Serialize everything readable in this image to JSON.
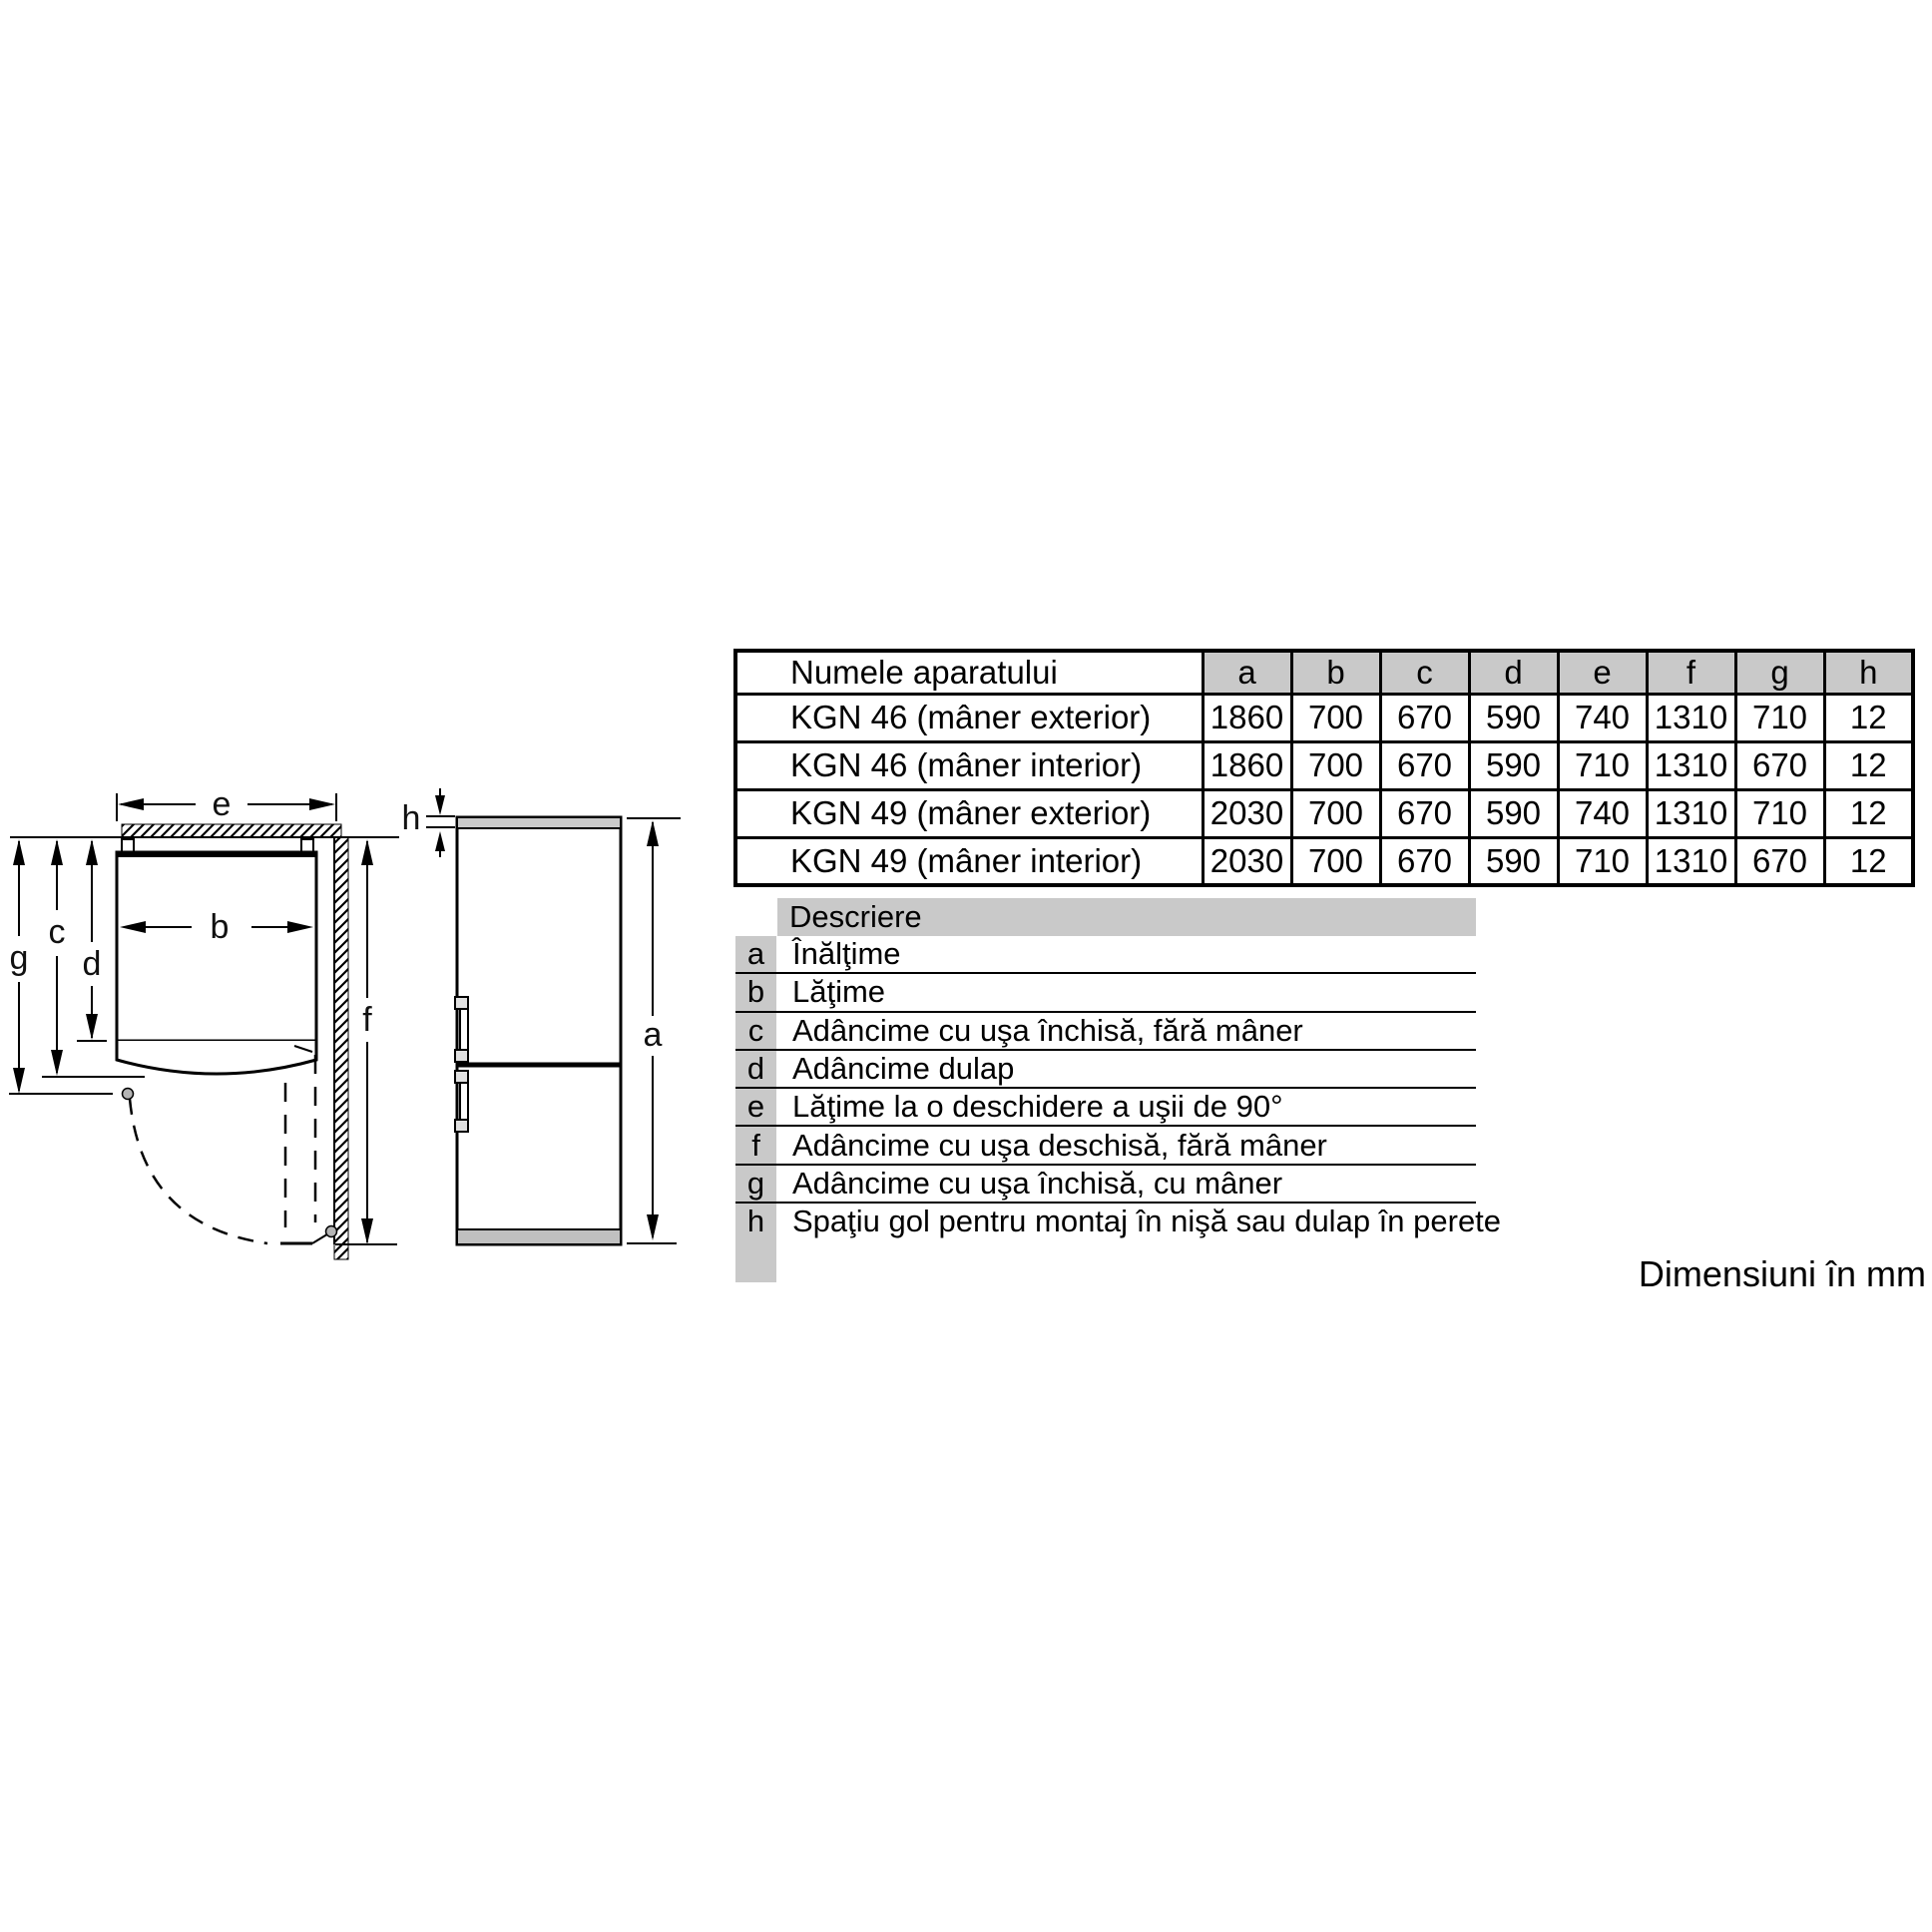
{
  "table": {
    "name_header": "Numele aparatului",
    "dim_headers": [
      "a",
      "b",
      "c",
      "d",
      "e",
      "f",
      "g",
      "h"
    ],
    "rows": [
      {
        "name": "KGN 46 (mâner exterior)",
        "values": [
          "1860",
          "700",
          "670",
          "590",
          "740",
          "1310",
          "710",
          "12"
        ]
      },
      {
        "name": "KGN 46 (mâner interior)",
        "values": [
          "1860",
          "700",
          "670",
          "590",
          "710",
          "1310",
          "670",
          "12"
        ]
      },
      {
        "name": "KGN 49 (mâner exterior)",
        "values": [
          "2030",
          "700",
          "670",
          "590",
          "740",
          "1310",
          "710",
          "12"
        ]
      },
      {
        "name": "KGN 49 (mâner interior)",
        "values": [
          "2030",
          "700",
          "670",
          "590",
          "710",
          "1310",
          "670",
          "12"
        ]
      }
    ]
  },
  "descriptions": {
    "header": "Descriere",
    "items": [
      {
        "key": "a",
        "text": "Înălţime"
      },
      {
        "key": "b",
        "text": "Lăţime"
      },
      {
        "key": "c",
        "text": "Adâncime cu uşa închisă, fără mâner"
      },
      {
        "key": "d",
        "text": "Adâncime dulap"
      },
      {
        "key": "e",
        "text": "Lăţime la o deschidere a uşii de 90°"
      },
      {
        "key": "f",
        "text": "Adâncime cu uşa deschisă, fără mâner"
      },
      {
        "key": "g",
        "text": "Adâncime cu uşa închisă, cu mâner"
      },
      {
        "key": "h",
        "text": "Spaţiu gol pentru montaj în nişă sau dulap în perete"
      }
    ]
  },
  "diagram": {
    "labels": {
      "a": "a",
      "b": "b",
      "c": "c",
      "d": "d",
      "e": "e",
      "f": "f",
      "g": "g",
      "h": "h"
    }
  },
  "footer": {
    "units_note": "Dimensiuni în mm"
  },
  "colors": {
    "cell_gray": "#c9c9c9",
    "plinth_gray": "#c0c0c0",
    "line_black": "#000000"
  }
}
